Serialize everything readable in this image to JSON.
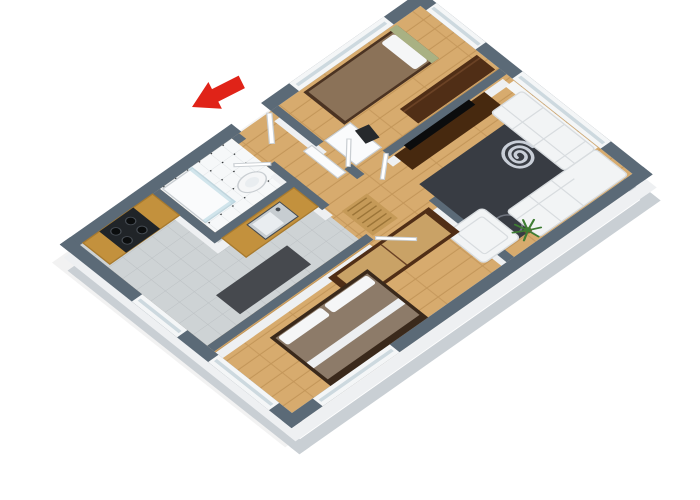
{
  "scene": {
    "type": "3d-floor-plan-render",
    "view": "axonometric, rotated ~35 degrees, white background",
    "rooms": [
      {
        "name": "bathroom",
        "floor": "white-tile-with-black-dots",
        "fixtures": [
          "corner-shower-glass",
          "pedestal-sink"
        ]
      },
      {
        "name": "kitchen",
        "floor": "gray-tile",
        "fixtures": [
          "l-shaped-ochre-counter",
          "stove-oven",
          "inset-sink",
          "dark-table"
        ]
      },
      {
        "name": "hallway",
        "floor": "wood",
        "fixtures": [
          "slatted-wood-bench",
          "white-radiator-panel",
          "open-doors"
        ]
      },
      {
        "name": "bedroom-top",
        "floor": "wood",
        "fixtures": [
          "single-bed",
          "white-desk",
          "dark-chair",
          "dark-wardrobe",
          "window"
        ]
      },
      {
        "name": "living-room",
        "floor": "wood",
        "fixtures": [
          "tv-console",
          "flatscreen-tv",
          "dark-spiral-rug",
          "white-corner-sofa",
          "white-armchair",
          "plant",
          "window"
        ]
      },
      {
        "name": "bedroom-bottom",
        "floor": "wood",
        "fixtures": [
          "double-bed",
          "two-tone-wardrobe",
          "windows"
        ]
      }
    ],
    "entrance_marker": "red-arrow-pointing-to-front-door"
  },
  "palette": {
    "bg": "#ffffff",
    "shadow": "#000000",
    "wallTop": "#5b6a77",
    "wallFaceMid": "#eef0f2",
    "wallFaceDeep": "#c9cfd4",
    "floorWood": "#d7ab6e",
    "floorWoodSeam": "#c39659",
    "tileKitchen": "#ced3d5",
    "tileKitchenLine": "#bcc1c4",
    "tileBath": "#f6f8f9",
    "tileBathLine": "#e0e4e6",
    "tileBathDot": "#26292c",
    "counter": "#c3913d",
    "counterEdge": "#a87a2e",
    "stove": "#202428",
    "burner": "#0b0d0e",
    "burnerRing": "#454b52",
    "sinkSteel": "#c7cdd1",
    "sinkInner": "#e9edf0",
    "tableDark": "#46494e",
    "benchWood": "#c59a58",
    "benchLine": "#9c7538",
    "bedFrame1": "#4b3322",
    "blanket1": "#8b7258",
    "pillowWhite": "#f5f6f7",
    "headboardGreen": "#a9b183",
    "deskWhite": "#fafbfc",
    "chairDark": "#26292c",
    "wardrobeDark": "#502e16",
    "wardrobeDarkEdge": "#6b4225",
    "tvConsole": "#47290f",
    "tvBlack": "#0b0c0d",
    "rugDark": "#383c43",
    "rugSpiral": "#c9cfd8",
    "rugSwirlFaint": "#70757f",
    "sofaWhite": "#f2f4f5",
    "sofaLine": "#d8dcdf",
    "plantGreen": "#3e7d33",
    "plantPot": "#7a5230",
    "arrowRed": "#e02318",
    "bedFrame2": "#3a291b",
    "blanket2": "#8d7b69",
    "throwWhite": "#edeff1",
    "wardrobe2Doors": "#c9a266",
    "doorWhite": "#ffffff",
    "doorStroke": "#c9ced2",
    "glass": "#bcd9e4",
    "windowWhite": "#f4f6f7",
    "windowGlassLine": "#cdd9df"
  }
}
